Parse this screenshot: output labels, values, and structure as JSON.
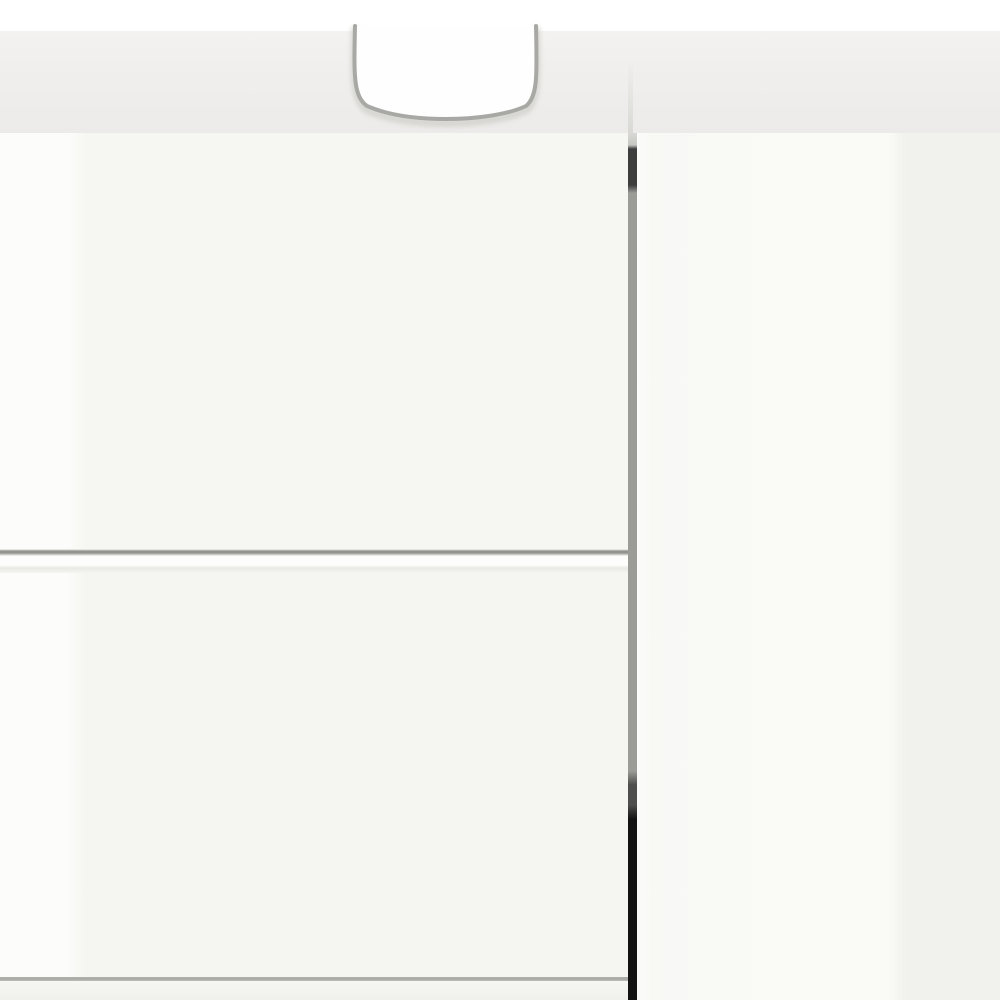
{
  "scene": {
    "type": "product-photo",
    "subject": "Close-up of a white high-gloss bathroom vanity cabinet with a U-shaped sink siphon cutout in the top panel, two handleless drawer fronts on the left, and a handleless door on the right separated by a shadowed vertical gap",
    "text_content": "none"
  },
  "colors": {
    "background_white": "#ffffff",
    "top_panel": "#f0efed",
    "top_panel_shadow": "#ecebe9",
    "band_crease": "#e3e3e0",
    "cutout_fill": "#fefefe",
    "cutout_outline": "#a8a8a5",
    "cutout_shadow": "#cfcfcb",
    "door_front_left": "#f6f6f2",
    "door_front_lower": "#f5f5f1",
    "right_door_light": "#fafaf7",
    "right_door_dark": "#f1f1ee",
    "gap_top_light": "#d9d9d6",
    "gap_dark_upper": "#3d3d3d",
    "gap_mid": "#9b9b98",
    "gap_dark_lower": "#4e4e4c",
    "gap_black": "#131313",
    "drawer_gap_line": "#94948f",
    "drawer_gap_highlight": "#fdfdfb",
    "drawer_gap_faint": "#e9e9e5",
    "bottom_line": "#a8a8a4",
    "plinth": "#f6f6f2",
    "plinth_dark": "#f0f0ec",
    "gloss_highlight": "rgba(255,255,255,0.72)"
  }
}
